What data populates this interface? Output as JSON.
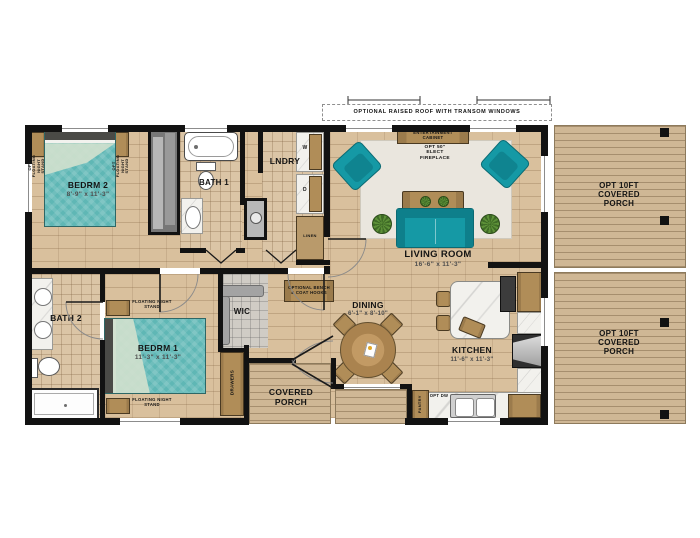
{
  "palette": {
    "accent_teal": "#1599a5",
    "bed_teal": "#5fb7b5",
    "wood": "#b08d58",
    "floor_wood": "#d9c09d",
    "deck": "#cfb795",
    "wall": "#121212",
    "marble": "#f2f1ed",
    "rug": "#eae6de"
  },
  "roof": {
    "note": "OPTIONAL RAISED ROOF WITH TRANSOM WINDOWS"
  },
  "rooms": {
    "bedrm2": {
      "name": "BEDRM 2",
      "dims": "8'-9\" x 11'-3\""
    },
    "bath1": {
      "name": "BATH 1"
    },
    "lndry": {
      "name": "LNDRY"
    },
    "living": {
      "name": "LIVING ROOM",
      "dims": "16'-6\" x 11'-3\""
    },
    "porch_upper": {
      "name": "OPT 10FT COVERED PORCH"
    },
    "porch_lower": {
      "name": "OPT 10FT COVERED PORCH"
    },
    "bath2": {
      "name": "BATH 2"
    },
    "bedrm1": {
      "name": "BEDRM 1",
      "dims": "11'-3\" x 11'-3\""
    },
    "wic": {
      "name": "WIC"
    },
    "dining": {
      "name": "DINING",
      "dims": "6'-1\" x 8'-10\""
    },
    "kitchen": {
      "name": "KITCHEN",
      "dims": "11'-6\" x 11'-3\""
    },
    "covered_porch": {
      "name": "COVERED PORCH"
    }
  },
  "annotations": {
    "opt_floating_night_stand_left": "OPT FLOATING NIGHT STAND",
    "opt_floating_night_stand_right": "OPT FLOATING NIGHT STAND",
    "floating_night_stand_top": "FLOATING NIGHT STAND",
    "floating_night_stand_bottom": "FLOATING NIGHT STAND",
    "entertainment_cabinet": "ENTERTAINMENT CABINET",
    "fireplace": "OPT 50\" ELECT FIREPLACE",
    "washer": "W",
    "dryer": "D",
    "linen": "LINEN",
    "drawers": "DRAWERS",
    "bench": "OPTIONAL BENCH & COAT HOOKS",
    "pantry": "PANTRY",
    "dishwasher": "OPT DW"
  }
}
